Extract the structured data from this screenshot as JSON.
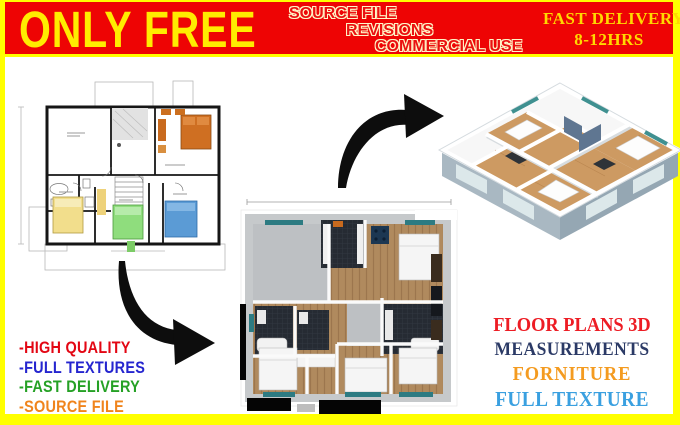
{
  "frame": {
    "border_color": "#ffff00",
    "content_background": "#ffffff"
  },
  "banner": {
    "headline": "ONLY FREE",
    "perks": [
      "SOURCE FILE",
      "REVISIONS",
      "COMMERCIAL USE"
    ],
    "delivery_line1": "FAST DELIVERY",
    "delivery_line2": "8-12HRS",
    "colors": {
      "background": "#ee0404",
      "headline": "#ffec00",
      "perks_fill": "#ea1111",
      "perks_outline": "#fff6c8",
      "delivery": "#ffd900"
    }
  },
  "left_features": {
    "items": [
      {
        "label": "-HIGH QUALITY",
        "color": "#e30613"
      },
      {
        "label": "-FULL TEXTURES",
        "color": "#2525cf"
      },
      {
        "label": "-FAST DELIVERY",
        "color": "#25a125"
      },
      {
        "label": "-SOURCE FILE",
        "color": "#f0841c"
      }
    ]
  },
  "right_features": {
    "items": [
      {
        "label": "FLOOR PLANS 3D",
        "color": "#ed1c24"
      },
      {
        "label": "MEASUREMENTS",
        "color": "#2b3a66"
      },
      {
        "label": "FORNITURE",
        "color": "#f49b20"
      },
      {
        "label": "FULL TEXTURE",
        "color": "#3aa0e0"
      }
    ]
  },
  "artwork": {
    "plan_2d": "2d-architectural-floor-plan",
    "render_top": "3d-top-down-floor-plan-render",
    "render_iso": "3d-isometric-floor-plan-render",
    "arrow_to_iso": "curved-arrow-up-right-icon",
    "arrow_to_top": "curved-arrow-down-right-icon"
  }
}
